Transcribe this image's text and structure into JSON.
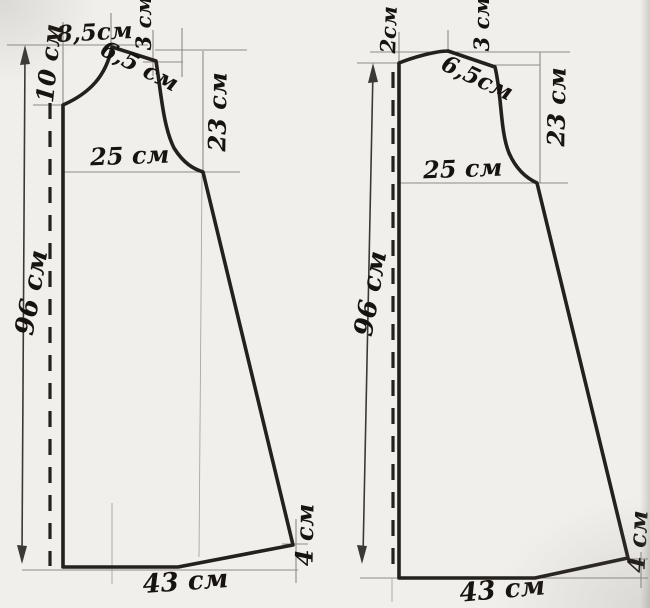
{
  "colors": {
    "background": "#f1efec",
    "outline": "#24201c",
    "guide": "#8f8b85",
    "guide_faint": "#aaa69f",
    "dimension": "#3c3833",
    "ink": "#17130e"
  },
  "left_piece": {
    "labels": {
      "neck_width": "8,5см",
      "shoulder_drop": "3 см",
      "neck_depth": "10 см",
      "shoulder_length": "6,5 см",
      "armhole_depth": "23 см",
      "chest_half_width": "25 см",
      "piece_length": "96 см",
      "hem_half_width": "43 см",
      "hem_side_rise": "4 см"
    }
  },
  "right_piece": {
    "labels": {
      "neck_depth": "2см",
      "shoulder_drop": "3 см",
      "shoulder_length": "6,5см",
      "armhole_depth": "23 см",
      "chest_half_width": "25 см",
      "piece_length": "96 см",
      "hem_half_width": "43 см",
      "hem_side_rise": "4 см"
    }
  }
}
